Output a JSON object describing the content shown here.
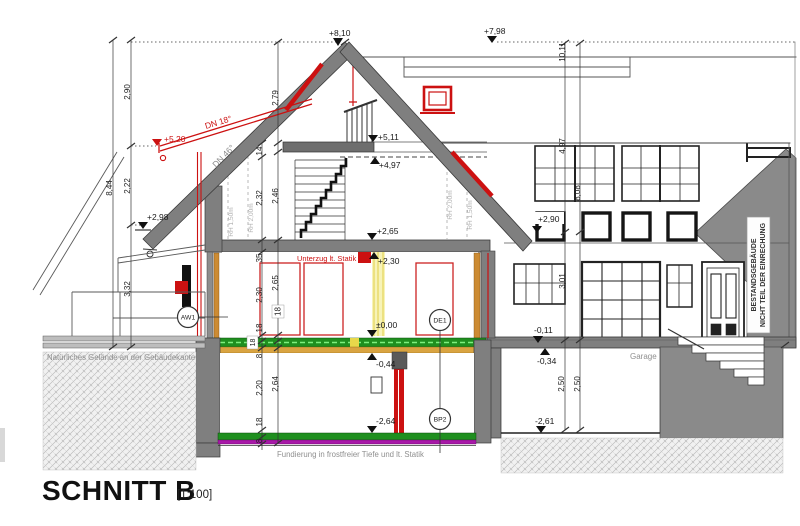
{
  "title": {
    "name": "SCHNITT B",
    "scale": "[1:100]"
  },
  "levels": {
    "p810": "+8,10",
    "p798": "+7,98",
    "p520": "+5,20",
    "p511": "+5,11",
    "p497": "+4,97",
    "p298": "+2,98",
    "p290": "+2,90",
    "p265": "+2,65",
    "p230": "+2,30",
    "p000": "±0,00",
    "m011": "-0,11",
    "m034": "-0,34",
    "m044": "-0,44",
    "m261": "-2,61",
    "m264": "-2,64"
  },
  "dims": {
    "total_height": "8,44",
    "roof_upper": "2,90",
    "roof_lower": "2,22",
    "wall_lower": "3,32",
    "chain_a": [
      "14",
      "2,32",
      "35",
      "2,30",
      "18",
      "8",
      "2,20",
      "18",
      "8"
    ],
    "chain_b": [
      "2,79",
      "2,46",
      "2,65",
      "2,64"
    ],
    "slab_box_a": "18",
    "slab_box_b": "18",
    "bg_total": "10,11",
    "bg_upper": "4,97",
    "bg_mid": "3,01",
    "bg_garage": "2,50",
    "bg_total2": "8,08",
    "bg_garage2": "2,50"
  },
  "roof": {
    "pitch_new": "DN 18°",
    "pitch_main": "DN 46°"
  },
  "headroom": {
    "left_150": "RH 1,50m",
    "left_200": "RH 2,00m",
    "right_200": "RH 2,00m",
    "right_150": "RH 1,50m"
  },
  "notes": {
    "unterzug": "Unterzug lt. Statik",
    "gelaende": "Natürliches Gelände an der Gebäudekante",
    "fundierung": "Fundierung in frostfreier Tiefe und lt. Statik",
    "garage": "Garage",
    "bestand_line1": "BESTANDSGEBÄUDE",
    "bestand_line2": "NICHT TEIL DER EINRECHUNG"
  },
  "tags": {
    "aw1": "AW1",
    "de1": "DE1",
    "bp2": "BP2"
  },
  "colors": {
    "wall_gray": "#7f7f7f",
    "accent_red": "#cc1111",
    "slab_green": "#1f8f1f",
    "slab_magenta": "#a818a8",
    "wood_orange": "#cc8b33",
    "insulation_yellow": "#f7f3b8"
  }
}
